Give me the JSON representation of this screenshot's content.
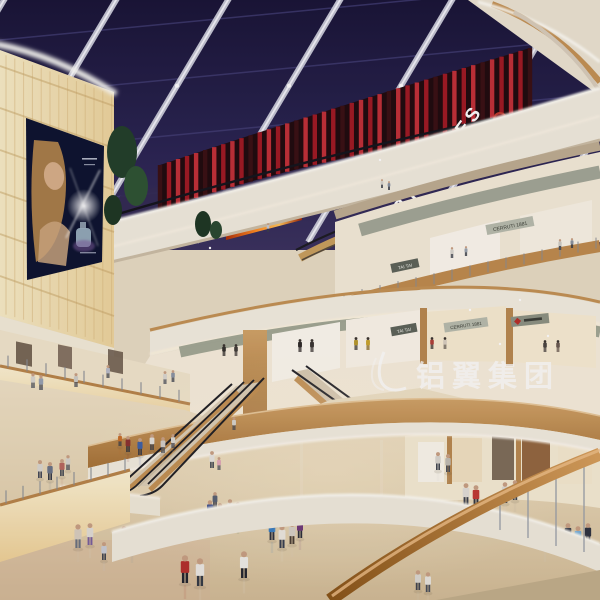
{
  "scene": {
    "description": "architectural rendering of a multi-level shopping mall atrium with skylight, theatre level, escalators and shoppers"
  },
  "signs": {
    "theatres": "THEATRES",
    "tai_tai": "TAI TAI",
    "cerruti": "CERRUTI 1881"
  },
  "watermark": {
    "text": "铝翼集团"
  },
  "colors": {
    "skylight": "#221e44",
    "beam": "#c5c6d4",
    "theatre_red": "#a01a24",
    "fascia_cream": "#f2ecdf",
    "wood": "#c49254",
    "glow_wall": "#f6e4b2",
    "floor": "#e6d6b8",
    "led_screen_orange": "#ff8c22"
  },
  "people": [
    {
      "x": 185,
      "y": 583,
      "h": 28,
      "c": "#b5302c",
      "p": "#23262e",
      "r": 1
    },
    {
      "x": 200,
      "y": 586,
      "h": 28,
      "c": "#ece9e4",
      "p": "#363b46",
      "r": 1
    },
    {
      "x": 244,
      "y": 578,
      "h": 27,
      "c": "#f0eee8",
      "p": "#23262f",
      "r": 1
    },
    {
      "x": 210,
      "y": 520,
      "h": 20,
      "c": "#3d4f8c",
      "p": "#2b2e39",
      "r": 1
    },
    {
      "x": 220,
      "y": 523,
      "h": 20,
      "c": "#8c2f2e",
      "p": "#30333e",
      "r": 1
    },
    {
      "x": 230,
      "y": 518,
      "h": 19,
      "c": "#e3e0da",
      "p": "#3f4450",
      "r": 1
    },
    {
      "x": 238,
      "y": 522,
      "h": 20,
      "c": "#2e6e4e",
      "p": "#262a33",
      "r": 1
    },
    {
      "x": 215,
      "y": 508,
      "h": 16,
      "c": "#5a6273",
      "p": "#333745",
      "r": 1
    },
    {
      "x": 272,
      "y": 540,
      "h": 22,
      "c": "#3a7fc2",
      "p": "#2e323d",
      "r": 1
    },
    {
      "x": 282,
      "y": 548,
      "h": 23,
      "c": "#ece8e0",
      "p": "#394050",
      "r": 1
    },
    {
      "x": 292,
      "y": 544,
      "h": 22,
      "c": "#d8d2c6",
      "p": "#4a3f35",
      "r": 1
    },
    {
      "x": 300,
      "y": 538,
      "h": 20,
      "c": "#703a7a",
      "p": "#2c2f3a",
      "r": 1
    },
    {
      "x": 275,
      "y": 525,
      "h": 16,
      "c": "#cfd3da",
      "p": "#3b3f4a",
      "r": 1
    },
    {
      "x": 124,
      "y": 548,
      "h": 22,
      "c": "#d8d5ce",
      "p": "#4c5260",
      "r": 1
    },
    {
      "x": 132,
      "y": 550,
      "h": 22,
      "c": "#8a93a5",
      "p": "#3a3f4b",
      "r": 1
    },
    {
      "x": 104,
      "y": 560,
      "h": 18,
      "c": "#c9cdd6",
      "p": "#3e4350",
      "r": 1
    },
    {
      "x": 78,
      "y": 548,
      "h": 24,
      "c": "#d9cfc0",
      "p": "#6b7280",
      "r": 1
    },
    {
      "x": 90,
      "y": 545,
      "h": 22,
      "c": "#e2ded6",
      "p": "#7a5f9e",
      "r": 1
    },
    {
      "x": 40,
      "y": 478,
      "h": 18,
      "c": "#dad7d0",
      "p": "#434856",
      "r": 1
    },
    {
      "x": 50,
      "y": 480,
      "h": 18,
      "c": "#6b7487",
      "p": "#343944",
      "r": 1
    },
    {
      "x": 62,
      "y": 476,
      "h": 17,
      "c": "#b8685f",
      "p": "#3c414d",
      "r": 1
    },
    {
      "x": 68,
      "y": 470,
      "h": 15,
      "c": "#d6d3cc",
      "p": "#474c58",
      "r": 1
    },
    {
      "x": 128,
      "y": 452,
      "h": 16,
      "c": "#8c3230",
      "p": "#2e323c",
      "r": 1
    },
    {
      "x": 140,
      "y": 455,
      "h": 17,
      "c": "#3f62a8",
      "p": "#343845",
      "r": 1
    },
    {
      "x": 152,
      "y": 450,
      "h": 16,
      "c": "#e4e1da",
      "p": "#3c414c",
      "r": 1
    },
    {
      "x": 163,
      "y": 453,
      "h": 16,
      "c": "#d2cfc8",
      "p": "#50565f",
      "r": 1
    },
    {
      "x": 120,
      "y": 446,
      "h": 13,
      "c": "#c9702a",
      "p": "#3a3e48",
      "r": 1
    },
    {
      "x": 173,
      "y": 448,
      "h": 14,
      "c": "#dcd9d2",
      "p": "#424754",
      "r": 1
    },
    {
      "x": 212,
      "y": 468,
      "h": 17,
      "c": "#e8e5df",
      "p": "#3c4450",
      "r": 0
    },
    {
      "x": 219,
      "y": 470,
      "h": 13,
      "c": "#e2a8b8",
      "p": "#4a4f5a",
      "r": 0
    },
    {
      "x": 234,
      "y": 430,
      "h": 13,
      "c": "#d8d5ce",
      "p": "#444954",
      "r": 0
    },
    {
      "x": 466,
      "y": 505,
      "h": 22,
      "c": "#e2dfd8",
      "p": "#3c414d",
      "r": 1
    },
    {
      "x": 476,
      "y": 507,
      "h": 22,
      "c": "#c23a34",
      "p": "#32363f",
      "r": 1
    },
    {
      "x": 505,
      "y": 503,
      "h": 21,
      "c": "#dddad3",
      "p": "#474c58",
      "r": 1
    },
    {
      "x": 515,
      "y": 500,
      "h": 20,
      "c": "#bdb49f",
      "p": "#3f444f",
      "r": 1
    },
    {
      "x": 545,
      "y": 548,
      "h": 24,
      "c": "#d8d5ce",
      "p": "#7a9ac0",
      "r": 1
    },
    {
      "x": 568,
      "y": 545,
      "h": 22,
      "c": "#3a3f4a",
      "p": "#2c303a",
      "r": 1
    },
    {
      "x": 578,
      "y": 548,
      "h": 22,
      "c": "#7ab0d8",
      "p": "#36589a",
      "r": 1
    },
    {
      "x": 588,
      "y": 544,
      "h": 21,
      "c": "#2e3340",
      "p": "#3f444f",
      "r": 1
    },
    {
      "x": 418,
      "y": 590,
      "h": 20,
      "c": "#dcd9d2",
      "p": "#40454f",
      "r": 1
    },
    {
      "x": 428,
      "y": 592,
      "h": 20,
      "c": "#e8e5de",
      "p": "#4a505c",
      "r": 1
    },
    {
      "x": 438,
      "y": 470,
      "h": 18,
      "c": "#d9d6cf",
      "p": "#3f444e",
      "r": 1
    },
    {
      "x": 448,
      "y": 472,
      "h": 18,
      "c": "#c2beb4",
      "p": "#4a4f59",
      "r": 1
    },
    {
      "x": 33,
      "y": 388,
      "h": 15,
      "c": "#d9d6cf",
      "p": "#494e5a",
      "r": 0
    },
    {
      "x": 41,
      "y": 390,
      "h": 15,
      "c": "#9aa3b2",
      "p": "#3f4450",
      "r": 0
    },
    {
      "x": 76,
      "y": 387,
      "h": 14,
      "c": "#cfccc5",
      "p": "#454a56",
      "r": 0
    },
    {
      "x": 165,
      "y": 384,
      "h": 13,
      "c": "#dad7d0",
      "p": "#4b505c",
      "r": 0
    },
    {
      "x": 173,
      "y": 382,
      "h": 12,
      "c": "#8c95a4",
      "p": "#3d424e",
      "r": 0
    },
    {
      "x": 108,
      "y": 378,
      "h": 13,
      "c": "#b8bcc8",
      "p": "#42474f",
      "r": 0
    },
    {
      "x": 452,
      "y": 258,
      "h": 11,
      "c": "#d8d5ce",
      "p": "#3a3f49",
      "r": 0
    },
    {
      "x": 466,
      "y": 256,
      "h": 10,
      "c": "#9aa3ae",
      "p": "#343943",
      "r": 0
    },
    {
      "x": 560,
      "y": 250,
      "h": 11,
      "c": "#cfccc4",
      "p": "#3f444e",
      "r": 0
    },
    {
      "x": 572,
      "y": 248,
      "h": 10,
      "c": "#8a93a0",
      "p": "#323741",
      "r": 0
    },
    {
      "x": 382,
      "y": 188,
      "h": 9,
      "c": "#d8d5ce",
      "p": "#3a3f49",
      "r": 0
    },
    {
      "x": 389,
      "y": 190,
      "h": 9,
      "c": "#8a93a2",
      "p": "#323742",
      "r": 0
    },
    {
      "x": 268,
      "y": 232,
      "h": 9,
      "c": "#c9ccd4",
      "p": "#3a3f49",
      "r": 0
    },
    {
      "x": 300,
      "y": 352,
      "h": 13,
      "c": "#2e2a28",
      "p": "#2e2a28",
      "r": 0,
      "m": 1
    },
    {
      "x": 312,
      "y": 352,
      "h": 13,
      "c": "#3a3632",
      "p": "#3a3632",
      "r": 0,
      "m": 1
    },
    {
      "x": 356,
      "y": 350,
      "h": 13,
      "c": "#b89a2e",
      "p": "#3a3632",
      "r": 0,
      "m": 1
    },
    {
      "x": 368,
      "y": 350,
      "h": 13,
      "c": "#caa52e",
      "p": "#8a6a22",
      "r": 0,
      "m": 1
    },
    {
      "x": 432,
      "y": 349,
      "h": 12,
      "c": "#b04038",
      "p": "#3a3632",
      "r": 0,
      "m": 1
    },
    {
      "x": 445,
      "y": 349,
      "h": 12,
      "c": "#d8cfc0",
      "p": "#6a6258",
      "r": 0,
      "m": 1
    },
    {
      "x": 545,
      "y": 352,
      "h": 12,
      "c": "#4a4440",
      "p": "#4a4440",
      "r": 0,
      "m": 1
    },
    {
      "x": 558,
      "y": 352,
      "h": 12,
      "c": "#6a5a50",
      "p": "#6a5a50",
      "r": 0,
      "m": 1
    },
    {
      "x": 224,
      "y": 356,
      "h": 12,
      "c": "#32302c",
      "p": "#32302c",
      "r": 0,
      "m": 1
    },
    {
      "x": 236,
      "y": 356,
      "h": 12,
      "c": "#403c38",
      "p": "#403c38",
      "r": 0,
      "m": 1
    }
  ],
  "glints": [
    {
      "x": 500,
      "y": 344,
      "s": 5
    },
    {
      "x": 548,
      "y": 336,
      "s": 4
    },
    {
      "x": 470,
      "y": 310,
      "s": 4
    },
    {
      "x": 380,
      "y": 160,
      "s": 4
    },
    {
      "x": 210,
      "y": 248,
      "s": 3
    },
    {
      "x": 520,
      "y": 300,
      "s": 3
    }
  ]
}
